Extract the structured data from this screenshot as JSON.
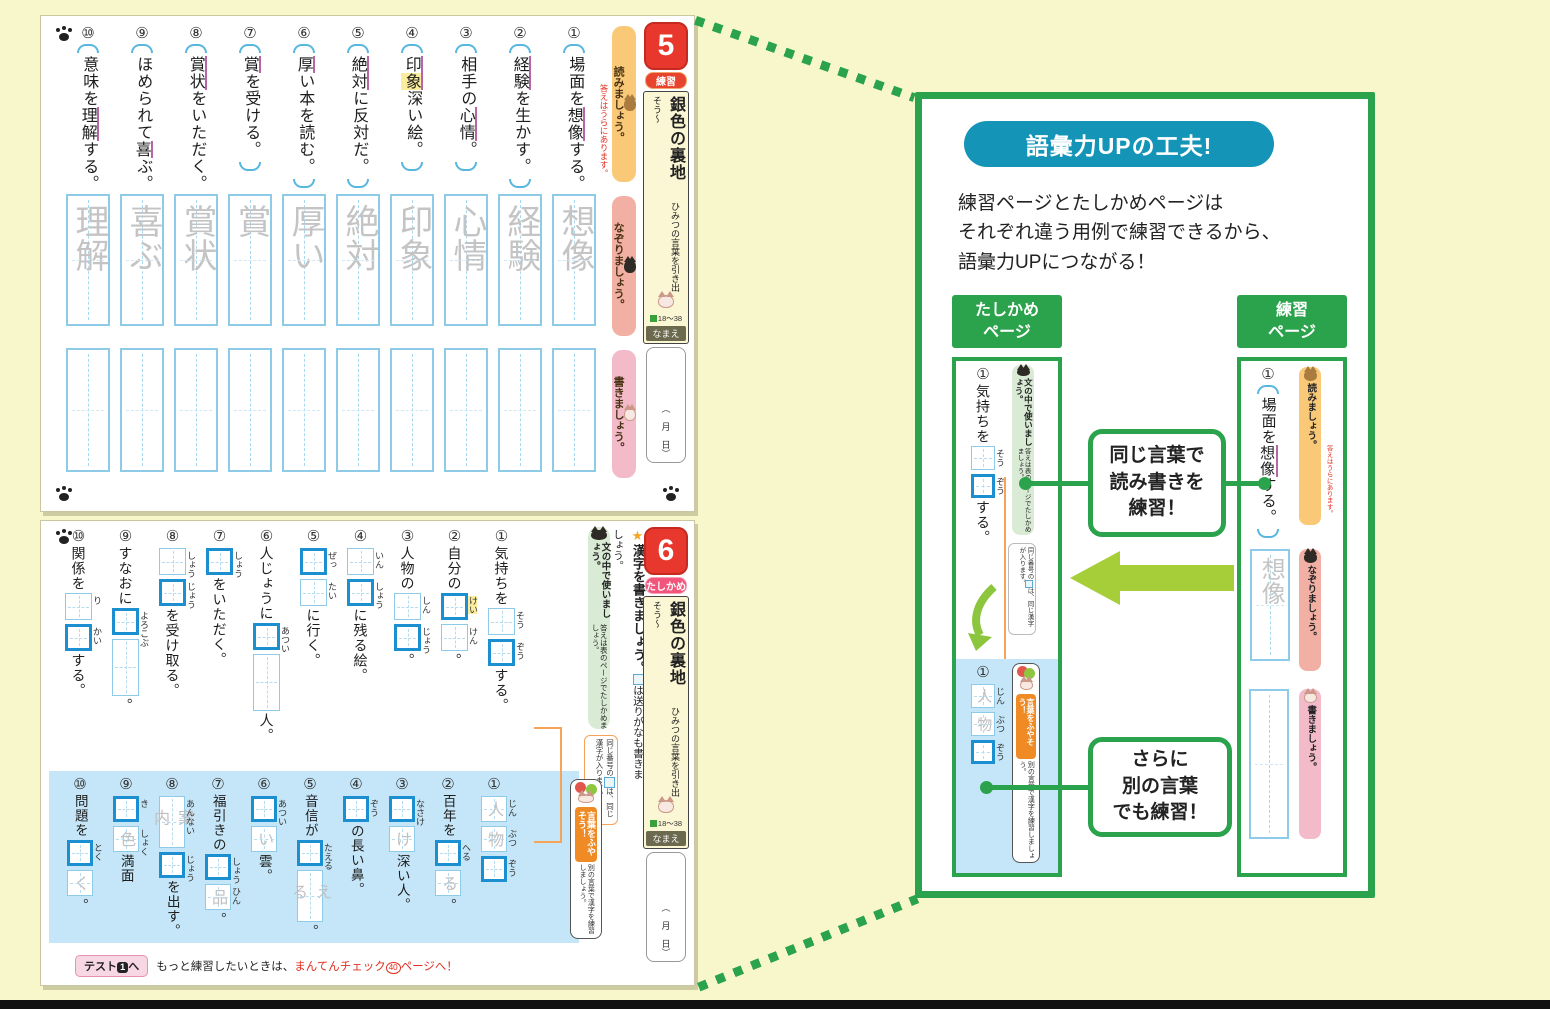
{
  "page5": {
    "num": "5",
    "badge": "練習",
    "title": "銀色の裏地",
    "subtitle": "ひみつの言葉を引き出そう～",
    "ref": "18～38",
    "name_label": "なまえ",
    "date": "（　月　日）",
    "read_label": "読みましょう。",
    "read_note": "答えはうらにあります。",
    "trace_label": "なぞりましょう。",
    "write_label": "書きましょう。",
    "items": [
      {
        "n": "①",
        "cells": [
          {
            "t": "場面を"
          },
          {
            "t": "想像",
            "u": true
          },
          {
            "t": "する。"
          }
        ]
      },
      {
        "n": "②",
        "cells": [
          {
            "t": "経験",
            "u": true
          },
          {
            "t": "を生かす。"
          }
        ]
      },
      {
        "n": "③",
        "cells": [
          {
            "t": "相手の"
          },
          {
            "t": "心情",
            "u": true
          },
          {
            "t": "。"
          }
        ]
      },
      {
        "n": "④",
        "cells": [
          {
            "t": "印",
            "u": true
          },
          {
            "t": "象",
            "u": true,
            "h": true
          },
          {
            "t": "深い絵。"
          }
        ]
      },
      {
        "n": "⑤",
        "cells": [
          {
            "t": "絶対",
            "u": true
          },
          {
            "t": "に反対だ。"
          }
        ]
      },
      {
        "n": "⑥",
        "cells": [
          {
            "t": "厚",
            "u": true
          },
          {
            "t": "い本を読む。"
          }
        ]
      },
      {
        "n": "⑦",
        "cells": [
          {
            "t": "賞",
            "u": true
          },
          {
            "t": "を受ける。"
          }
        ]
      },
      {
        "n": "⑧",
        "cells": [
          {
            "t": "賞状",
            "u": true
          },
          {
            "t": "をいただく。"
          }
        ]
      },
      {
        "n": "⑨",
        "cells": [
          {
            "t": "ほめられて"
          },
          {
            "t": "喜",
            "u": true
          },
          {
            "t": "ぶ。"
          }
        ]
      },
      {
        "n": "⑩",
        "cells": [
          {
            "t": "意味を"
          },
          {
            "t": "理解",
            "u": true
          },
          {
            "t": "する。"
          }
        ]
      }
    ],
    "trace_chars": [
      "想像",
      "経験",
      "心情",
      "印象",
      "絶対",
      "厚い",
      "賞",
      "賞状",
      "喜ぶ",
      "理解"
    ]
  },
  "page6": {
    "num": "6",
    "badge": "たしかめ",
    "title": "銀色の裏地",
    "subtitle": "ひみつの言葉を引き出そう～",
    "ref": "18～38",
    "name_label": "なまえ",
    "date": "（　月　日）",
    "instr_star": "★",
    "instr1": "漢字を書きましょう。",
    "instr2": "は送りがなも書きましょう。",
    "strip1": "文の中で使いましょう。",
    "strip2": "答えは表のページでたしかめましょう。",
    "note1": "同じ番号の",
    "note2": "は、同じ漢字が入ります。",
    "vocab_badge": "言葉をふやそう！",
    "vocab_note": "別の言葉で漢字を練習しましょう。",
    "footer_tag_pre": "テスト",
    "footer_tag_num": "1",
    "footer_tag_post": "へ",
    "footer_text": "もっと練習したいときは、",
    "footer_red1": "まんてんチェック",
    "footer_circle": "40",
    "footer_red2": "ページへ！",
    "top_items": [
      {
        "n": "①",
        "cells": [
          {
            "t": "気持ちを"
          },
          {
            "box": "light",
            "k": "そう"
          },
          {
            "box": "bold",
            "k": "ぞう"
          },
          {
            "t": "する。"
          }
        ]
      },
      {
        "n": "②",
        "cells": [
          {
            "t": "自分の"
          },
          {
            "box": "bold",
            "k": "けい",
            "h": true
          },
          {
            "box": "light",
            "k": "けん"
          },
          {
            "t": "。"
          }
        ]
      },
      {
        "n": "③",
        "cells": [
          {
            "t": "人物の"
          },
          {
            "box": "light",
            "k": "しん"
          },
          {
            "box": "bold",
            "k": "じょう"
          },
          {
            "t": "。"
          }
        ]
      },
      {
        "n": "④",
        "cells": [
          {
            "box": "light",
            "k": "いん"
          },
          {
            "box": "bold",
            "k": "しょう"
          },
          {
            "t": "に残る絵。"
          }
        ]
      },
      {
        "n": "⑤",
        "cells": [
          {
            "box": "bold",
            "k": "ぜっ"
          },
          {
            "box": "light",
            "k": "たい"
          },
          {
            "t": "に行く。"
          }
        ]
      },
      {
        "n": "⑥",
        "cells": [
          {
            "t": "人じょうに"
          },
          {
            "box": "bold",
            "k": "あつい"
          },
          {
            "box": "tall"
          },
          {
            "t": "人。"
          }
        ]
      },
      {
        "n": "⑦",
        "cells": [
          {
            "box": "bold",
            "k": "しょう"
          },
          {
            "t": "をいただく。"
          }
        ]
      },
      {
        "n": "⑧",
        "cells": [
          {
            "box": "light",
            "k": "しょう"
          },
          {
            "box": "bold",
            "k": "じょう"
          },
          {
            "t": "を受け取る。"
          }
        ]
      },
      {
        "n": "⑨",
        "cells": [
          {
            "t": "すなおに"
          },
          {
            "box": "bold",
            "k": "よろこぶ"
          },
          {
            "box": "tall"
          },
          {
            "t": "。"
          }
        ]
      },
      {
        "n": "⑩",
        "cells": [
          {
            "t": "関係を"
          },
          {
            "box": "light",
            "k": "り"
          },
          {
            "box": "bold",
            "k": "かい"
          },
          {
            "t": "する。"
          }
        ]
      }
    ],
    "bottom_items": [
      {
        "n": "①",
        "cells": [
          {
            "tr": "人",
            "k": "じん"
          },
          {
            "tr": "物",
            "k": "ぶつ"
          },
          {
            "box": "bold",
            "k": "ぞう"
          }
        ]
      },
      {
        "n": "②",
        "cells": [
          {
            "t": "百年を"
          },
          {
            "box": "bold",
            "k": "へる"
          },
          {
            "tr": "る"
          },
          {
            "t": "。"
          }
        ]
      },
      {
        "n": "③",
        "cells": [
          {
            "box": "bold",
            "k": "なさけ"
          },
          {
            "tr": "け"
          },
          {
            "t": "深い人。"
          }
        ]
      },
      {
        "n": "④",
        "cells": [
          {
            "box": "bold",
            "k": "ぞう"
          },
          {
            "t": "の長い鼻。"
          }
        ]
      },
      {
        "n": "⑤",
        "cells": [
          {
            "t": "音信が"
          },
          {
            "box": "bold",
            "k": "たえる"
          },
          {
            "tr": "える"
          },
          {
            "t": "。"
          }
        ]
      },
      {
        "n": "⑥",
        "cells": [
          {
            "box": "bold",
            "k": "あつい"
          },
          {
            "tr": "い"
          },
          {
            "t": "雲。"
          }
        ]
      },
      {
        "n": "⑦",
        "cells": [
          {
            "t": "福引きの"
          },
          {
            "box": "bold",
            "k": "しょう"
          },
          {
            "tr": "品",
            "k": "ひん"
          },
          {
            "t": "。"
          }
        ]
      },
      {
        "n": "⑧",
        "cells": [
          {
            "tr": "案内",
            "k": "あんない"
          },
          {
            "box": "bold",
            "k": "じょう"
          },
          {
            "t": "を出す。"
          }
        ]
      },
      {
        "n": "⑨",
        "cells": [
          {
            "box": "bold",
            "k": "き"
          },
          {
            "tr": "色",
            "k": "しょく"
          },
          {
            "t": "満面"
          }
        ]
      },
      {
        "n": "⑩",
        "cells": [
          {
            "t": "問題を"
          },
          {
            "box": "bold",
            "k": "とく"
          },
          {
            "tr": "く"
          },
          {
            "t": "。"
          }
        ]
      }
    ]
  },
  "panel": {
    "title": "語彙力UPの工夫!",
    "body": "練習ページとたしかめページは\nそれぞれ違う用例で練習できるから、\n語彙力UPにつながる！",
    "left_header": "たしかめ\nページ",
    "right_header": "練習\nページ",
    "callout1": "同じ言葉で\n読み書きを\n練習！",
    "callout2": "さらに\n別の言葉\nでも練習！",
    "mini_left": {
      "items": [
        {
          "n": "①",
          "cells": [
            {
              "t": "気持ちを"
            },
            {
              "box": "light",
              "k": "そう"
            },
            {
              "box": "bold",
              "k": "ぞう"
            },
            {
              "t": "する。"
            }
          ]
        }
      ],
      "items2": [
        {
          "n": "①",
          "cells": [
            {
              "tr": "人",
              "k": "じん"
            },
            {
              "tr": "物",
              "k": "ぶつ"
            },
            {
              "box": "bold",
              "k": "ぞう"
            }
          ]
        }
      ],
      "strip1": "文の中で使いましょう。",
      "strip2": "答えは表のページでたしかめましょう。",
      "note1": "同じ番号の",
      "note2": "は、同じ漢字が入ります。",
      "vocab_badge": "言葉をふやそう！",
      "vocab_note": "別の言葉で漢字を練習しましょう。"
    },
    "mini_right": {
      "items": [
        {
          "n": "①",
          "cells": [
            {
              "t": "場面を"
            },
            {
              "t": "想像",
              "u": true
            },
            {
              "t": "する。"
            }
          ]
        }
      ],
      "read_label": "読みましょう。",
      "read_note": "答えはうらにあります。",
      "trace_chars": [
        "想像"
      ],
      "trace_label": "なぞりましょう。",
      "write_label": "書きましょう。"
    }
  }
}
